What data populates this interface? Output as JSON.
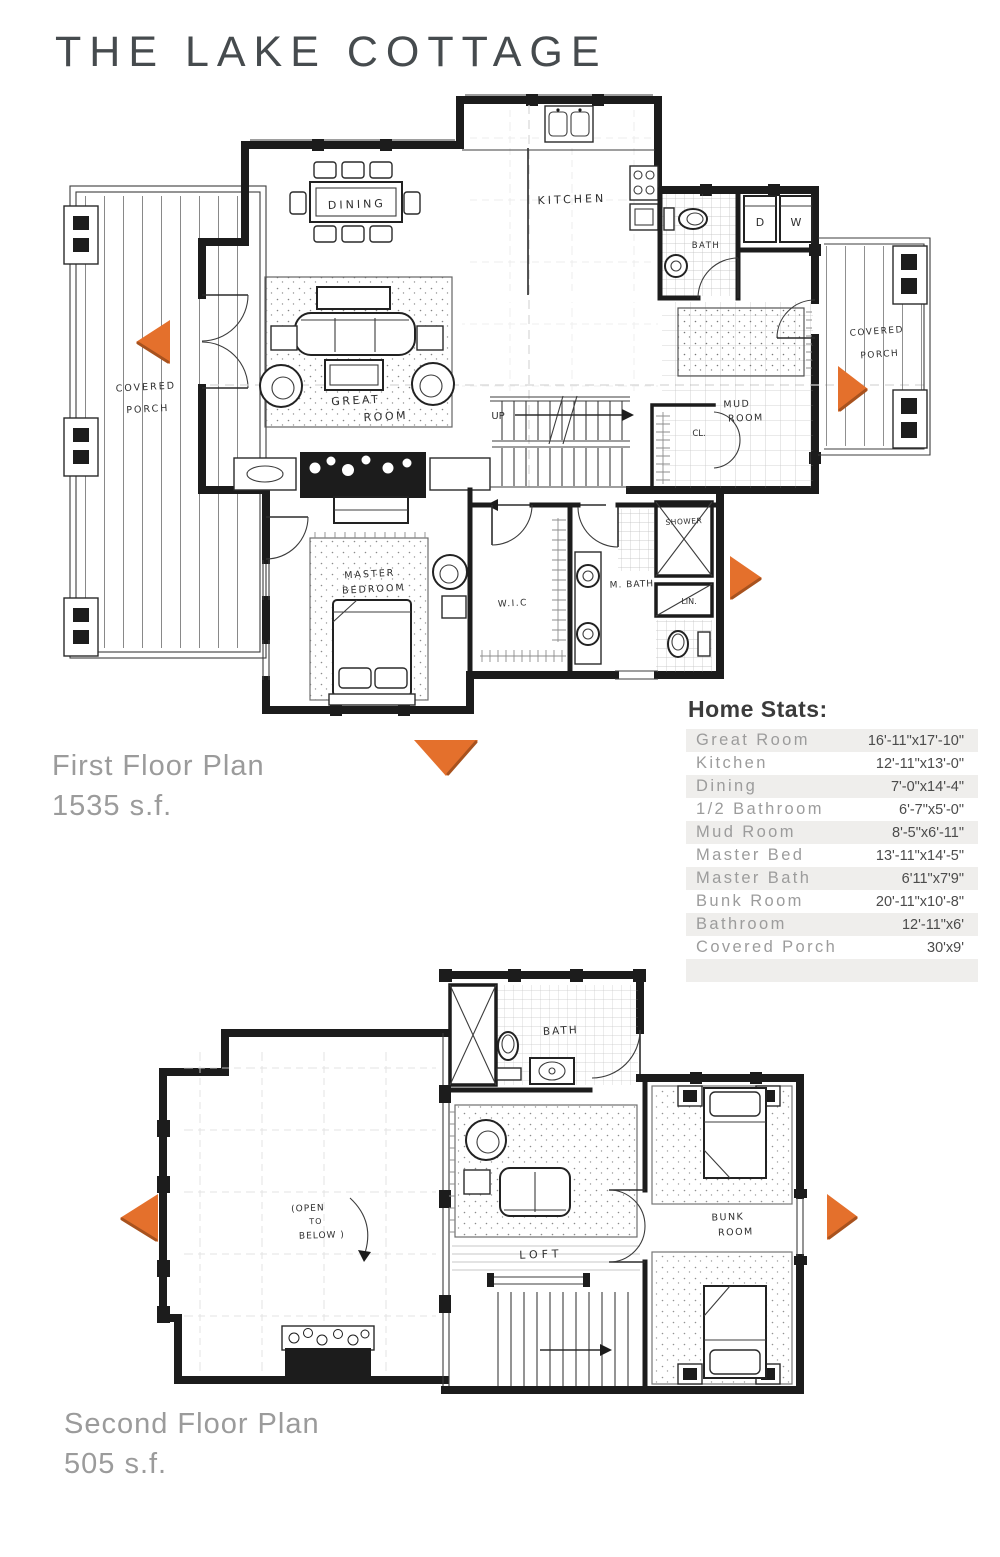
{
  "page": {
    "title": "THE LAKE COTTAGE"
  },
  "first_floor": {
    "caption_title": "First Floor Plan",
    "caption_area": "1535 s.f.",
    "labels": {
      "covered_porch_left_1": "COVERED",
      "covered_porch_left_2": "PORCH",
      "dining": "DINING",
      "kitchen": "KITCHEN",
      "half_bath": "BATH",
      "dryer": "D",
      "washer": "W",
      "covered_porch_right_1": "COVERED",
      "covered_porch_right_2": "PORCH",
      "great_room_1": "GREAT",
      "great_room_2": "ROOM",
      "up": "UP",
      "mud_room_1": "MUD",
      "mud_room_2": "ROOM",
      "closet": "CL.",
      "master_bed_1": "MASTER",
      "master_bed_2": "BEDROOM",
      "wic": "W.I.C",
      "master_bath": "M. BATH",
      "shower": "SHOWER",
      "linen": "LIN."
    }
  },
  "second_floor": {
    "caption_title": "Second Floor Plan",
    "caption_area": "505 s.f.",
    "labels": {
      "bath": "BATH",
      "open_1": "(OPEN",
      "open_2": "TO",
      "open_3": "BELOW )",
      "loft": "LOFT",
      "bunk_1": "BUNK",
      "bunk_2": "ROOM"
    }
  },
  "stats": {
    "heading": "Home Stats:",
    "rows": [
      {
        "name": "Great Room",
        "size": "16'-11\"x17'-10\""
      },
      {
        "name": "Kitchen",
        "size": "12'-11\"x13'-0\""
      },
      {
        "name": "Dining",
        "size": "7'-0\"x14'-4\""
      },
      {
        "name": "1/2 Bathroom",
        "size": "6'-7\"x5'-0\""
      },
      {
        "name": "Mud Room",
        "size": "8'-5\"x6'-11\""
      },
      {
        "name": "Master Bed",
        "size": "13'-11\"x14'-5\""
      },
      {
        "name": "Master Bath",
        "size": "6'11\"x7'9\""
      },
      {
        "name": "Bunk Room",
        "size": "20'-11\"x10'-8\""
      },
      {
        "name": "Bathroom",
        "size": "12'-11\"x6'"
      },
      {
        "name": "Covered Porch",
        "size": "30'x9'"
      }
    ]
  },
  "colors": {
    "accent_orange": "#e4702c",
    "ink": "#1c1c1c"
  }
}
